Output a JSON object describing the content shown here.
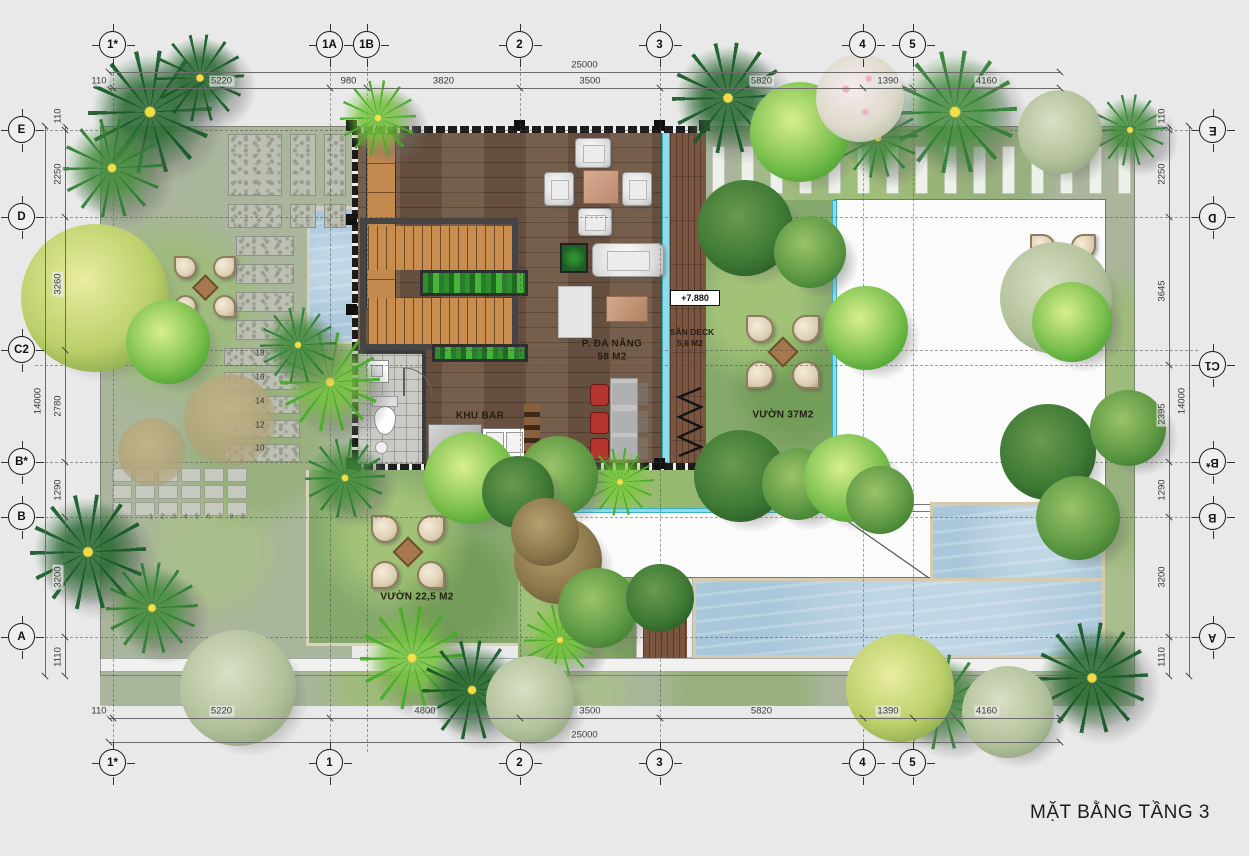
{
  "title": "MẶT BẰNG TẦNG 3",
  "elevation_marker": {
    "text": "+7.880"
  },
  "labels": [
    {
      "text": "P. ĐA NĂNG",
      "x": 612,
      "y": 344,
      "cls": "room"
    },
    {
      "text": "58 M2",
      "x": 612,
      "y": 357,
      "cls": "room"
    },
    {
      "text": "SÂN DECK",
      "x": 692,
      "y": 332,
      "cls": "room-sm"
    },
    {
      "text": "5,6 M2",
      "x": 690,
      "y": 343,
      "cls": "room-sm"
    },
    {
      "text": "VƯỜN 37M2",
      "x": 783,
      "y": 415,
      "cls": "room"
    },
    {
      "text": "KHU BAR",
      "x": 480,
      "y": 416,
      "cls": "room"
    },
    {
      "text": "VƯỜN 22,5 M2",
      "x": 417,
      "y": 597,
      "cls": "room"
    }
  ],
  "grid": {
    "cols": [
      {
        "label": "1*",
        "x": 113
      },
      {
        "label": "1A",
        "x": 330
      },
      {
        "label": "1B",
        "x": 367
      },
      {
        "label": "2",
        "x": 520
      },
      {
        "label": "3",
        "x": 660
      },
      {
        "label": "4",
        "x": 863
      },
      {
        "label": "5",
        "x": 913
      }
    ],
    "rows": [
      {
        "label": "E",
        "y": 130
      },
      {
        "label": "D",
        "y": 217
      },
      {
        "label": "C2",
        "y": 350
      },
      {
        "label": "C1",
        "y": 365
      },
      {
        "label": "B*",
        "y": 462
      },
      {
        "label": "B",
        "y": 517
      },
      {
        "label": "A",
        "y": 637
      }
    ],
    "bubbles": [
      {
        "label": "1*",
        "x": 113,
        "y": 45
      },
      {
        "label": "1A",
        "x": 330,
        "y": 45
      },
      {
        "label": "1B",
        "x": 367,
        "y": 45
      },
      {
        "label": "2",
        "x": 520,
        "y": 45
      },
      {
        "label": "3",
        "x": 660,
        "y": 45
      },
      {
        "label": "4",
        "x": 863,
        "y": 45
      },
      {
        "label": "5",
        "x": 913,
        "y": 45
      },
      {
        "label": "1*",
        "x": 113,
        "y": 763
      },
      {
        "label": "1",
        "x": 330,
        "y": 763
      },
      {
        "label": "2",
        "x": 520,
        "y": 763
      },
      {
        "label": "3",
        "x": 660,
        "y": 763
      },
      {
        "label": "4",
        "x": 863,
        "y": 763
      },
      {
        "label": "5",
        "x": 913,
        "y": 763
      },
      {
        "label": "E",
        "x": 22,
        "y": 130
      },
      {
        "label": "D",
        "x": 22,
        "y": 217
      },
      {
        "label": "C2",
        "x": 22,
        "y": 350
      },
      {
        "label": "B*",
        "x": 22,
        "y": 462
      },
      {
        "label": "B",
        "x": 22,
        "y": 517
      },
      {
        "label": "A",
        "x": 22,
        "y": 637
      },
      {
        "label": "E",
        "x": 1213,
        "y": 130,
        "rot": true
      },
      {
        "label": "D",
        "x": 1213,
        "y": 217,
        "rot": true
      },
      {
        "label": "C1",
        "x": 1213,
        "y": 365,
        "rot": true
      },
      {
        "label": "B*",
        "x": 1213,
        "y": 462,
        "rot": true
      },
      {
        "label": "B",
        "x": 1213,
        "y": 517,
        "rot": true
      },
      {
        "label": "A",
        "x": 1213,
        "y": 637,
        "rot": true
      }
    ]
  },
  "dims": {
    "top": {
      "total": {
        "label": "25000",
        "from": 109,
        "to": 1060,
        "y": 72
      },
      "line_y": 88,
      "segments": [
        {
          "label": "110",
          "from": 109,
          "to": 113
        },
        {
          "label": "5220",
          "from": 113,
          "to": 330
        },
        {
          "label": "980",
          "from": 330,
          "to": 367
        },
        {
          "label": "3820",
          "from": 367,
          "to": 520
        },
        {
          "label": "3500",
          "from": 520,
          "to": 660
        },
        {
          "label": "5820",
          "from": 660,
          "to": 863
        },
        {
          "label": "1390",
          "from": 863,
          "to": 913
        },
        {
          "label": "4160",
          "from": 913,
          "to": 1060
        }
      ]
    },
    "bottom": {
      "total": {
        "label": "25000",
        "from": 109,
        "to": 1060,
        "y": 742
      },
      "line_y": 718,
      "segments": [
        {
          "label": "110",
          "from": 109,
          "to": 113
        },
        {
          "label": "5220",
          "from": 113,
          "to": 330
        },
        {
          "label": "4800",
          "from": 330,
          "to": 520
        },
        {
          "label": "3500",
          "from": 520,
          "to": 660
        },
        {
          "label": "5820",
          "from": 660,
          "to": 863
        },
        {
          "label": "1390",
          "from": 863,
          "to": 913
        },
        {
          "label": "4160",
          "from": 913,
          "to": 1060
        }
      ]
    },
    "left": {
      "total": {
        "label": "14000",
        "from": 126,
        "to": 676,
        "x": 45
      },
      "line_x": 65,
      "segments": [
        {
          "label": "110",
          "from": 126,
          "to": 130
        },
        {
          "label": "2250",
          "from": 130,
          "to": 217
        },
        {
          "label": "3260",
          "from": 217,
          "to": 350
        },
        {
          "label": "2780",
          "from": 350,
          "to": 462
        },
        {
          "label": "1290",
          "from": 462,
          "to": 517
        },
        {
          "label": "3200",
          "from": 517,
          "to": 637
        },
        {
          "label": "1110",
          "from": 637,
          "to": 676
        }
      ]
    },
    "right": {
      "total": {
        "label": "14000",
        "from": 126,
        "to": 676,
        "x": 1189
      },
      "line_x": 1169,
      "segments": [
        {
          "label": "110",
          "from": 126,
          "to": 130
        },
        {
          "label": "2250",
          "from": 130,
          "to": 217
        },
        {
          "label": "3645",
          "from": 217,
          "to": 365
        },
        {
          "label": "2395",
          "from": 365,
          "to": 462
        },
        {
          "label": "1290",
          "from": 462,
          "to": 517
        },
        {
          "label": "3200",
          "from": 517,
          "to": 637
        },
        {
          "label": "1110",
          "from": 637,
          "to": 676
        }
      ]
    }
  },
  "steps": {
    "x": 260,
    "numbers": [
      {
        "t": "18",
        "y": 353
      },
      {
        "t": "16",
        "y": 377
      },
      {
        "t": "14",
        "y": 401
      },
      {
        "t": "12",
        "y": 425
      },
      {
        "t": "10",
        "y": 448
      }
    ],
    "path_numbers": [
      "1",
      "2",
      "3",
      "4",
      "5",
      "6",
      "7",
      "8",
      "9"
    ],
    "path_x0": 151,
    "path_dx": 11.5,
    "path_y": 517
  },
  "hardscape": {
    "tiles": [
      [
        228,
        134,
        54,
        62
      ],
      [
        290,
        134,
        26,
        62
      ],
      [
        324,
        134,
        22,
        62
      ],
      [
        228,
        204,
        54,
        24
      ],
      [
        290,
        204,
        26,
        24
      ],
      [
        324,
        204,
        22,
        24
      ]
    ],
    "slabs": [
      [
        236,
        236,
        58,
        20
      ],
      [
        236,
        264,
        58,
        20
      ],
      [
        236,
        292,
        58,
        20
      ],
      [
        236,
        320,
        58,
        20
      ]
    ],
    "step_slabs": [
      [
        224,
        348,
        76,
        18
      ],
      [
        224,
        372,
        76,
        18
      ],
      [
        224,
        396,
        76,
        18
      ],
      [
        224,
        420,
        76,
        18
      ],
      [
        224,
        444,
        76,
        18
      ]
    ],
    "small_tiles": {
      "x": 112,
      "y": 468,
      "cols": 6,
      "rows": 3,
      "w": 20,
      "h": 14,
      "gap": 3
    },
    "slat_strip": {
      "x": 712,
      "y": 146,
      "count": 15,
      "step": 29,
      "w": 13,
      "h": 48
    }
  },
  "seatings": [
    {
      "x": 205,
      "y": 287,
      "s": 0.85
    },
    {
      "x": 783,
      "y": 352,
      "s": 1
    },
    {
      "x": 408,
      "y": 552,
      "s": 1
    },
    {
      "x": 1063,
      "y": 267,
      "s": 0.9
    }
  ],
  "trees": [
    [
      "palm",
      "dark",
      150,
      112,
      62
    ],
    [
      "palm",
      "mid",
      112,
      168,
      50
    ],
    [
      "palm",
      "dark",
      200,
      78,
      44
    ],
    [
      "palm",
      "bright",
      378,
      118,
      38
    ],
    [
      "palm",
      "bright",
      330,
      382,
      50
    ],
    [
      "palm",
      "mid",
      298,
      345,
      38
    ],
    [
      "palm",
      "dark",
      88,
      552,
      58
    ],
    [
      "palm",
      "mid",
      152,
      608,
      46
    ],
    [
      "palm",
      "bright",
      412,
      658,
      52
    ],
    [
      "palm",
      "mid",
      345,
      478,
      40
    ],
    [
      "palm",
      "dark",
      472,
      690,
      50
    ],
    [
      "palm",
      "dark",
      728,
      98,
      56
    ],
    [
      "palm",
      "mid",
      955,
      112,
      62
    ],
    [
      "palm",
      "mid",
      878,
      138,
      40
    ],
    [
      "palm",
      "dark",
      1092,
      678,
      56
    ],
    [
      "palm",
      "mid",
      942,
      702,
      48
    ],
    [
      "palm",
      "bright",
      620,
      482,
      34
    ],
    [
      "palm",
      "bright",
      560,
      640,
      36
    ],
    [
      "palm",
      "mid",
      1130,
      130,
      36
    ],
    [
      "canopy",
      "yellow",
      95,
      298,
      74
    ],
    [
      "canopy",
      "bright",
      168,
      342,
      42
    ],
    [
      "canopy",
      "bright",
      800,
      132,
      50
    ],
    [
      "canopy",
      "pink",
      860,
      98,
      44
    ],
    [
      "canopy",
      "pale",
      1060,
      132,
      42
    ],
    [
      "canopy",
      "dark",
      745,
      228,
      48
    ],
    [
      "canopy",
      "mid",
      810,
      252,
      36
    ],
    [
      "canopy",
      "bright",
      866,
      328,
      42
    ],
    [
      "canopy",
      "dark",
      740,
      476,
      46
    ],
    [
      "canopy",
      "mid",
      798,
      484,
      36
    ],
    [
      "canopy",
      "pale",
      1056,
      298,
      56
    ],
    [
      "canopy",
      "bright",
      1072,
      322,
      40
    ],
    [
      "canopy",
      "dark",
      1048,
      452,
      48
    ],
    [
      "canopy",
      "mid",
      1078,
      518,
      42
    ],
    [
      "canopy",
      "bright",
      470,
      478,
      46
    ],
    [
      "canopy",
      "mid",
      558,
      476,
      40
    ],
    [
      "canopy",
      "dark",
      518,
      492,
      36
    ],
    [
      "canopy",
      "brown",
      558,
      560,
      44
    ],
    [
      "canopy",
      "mid",
      598,
      608,
      40
    ],
    [
      "canopy",
      "dark",
      660,
      598,
      34
    ],
    [
      "canopy",
      "yellow",
      900,
      688,
      54
    ],
    [
      "canopy",
      "pale",
      1008,
      712,
      46
    ],
    [
      "canopy",
      "pale",
      238,
      688,
      58
    ],
    [
      "canopy",
      "pale",
      530,
      700,
      44
    ],
    [
      "canopy",
      "bright",
      848,
      478,
      44
    ],
    [
      "canopy",
      "mid",
      880,
      500,
      34
    ],
    [
      "canopy",
      "sand",
      230,
      420,
      46
    ],
    [
      "canopy",
      "sand",
      152,
      452,
      34
    ],
    [
      "canopy",
      "brown",
      545,
      532,
      34
    ],
    [
      "canopy",
      "mid",
      1128,
      428,
      38
    ]
  ],
  "columns": [
    [
      346,
      120
    ],
    [
      514,
      120
    ],
    [
      654,
      120
    ],
    [
      699,
      120
    ],
    [
      346,
      214
    ],
    [
      346,
      304
    ],
    [
      346,
      458
    ],
    [
      514,
      458
    ],
    [
      654,
      458
    ],
    [
      699,
      458
    ]
  ],
  "bar": {
    "stool_ys": [
      384,
      412,
      438
    ]
  },
  "colors": {
    "background": "#e9e9e9",
    "grass": "#a9b69b",
    "grass_bright": "#85a86d",
    "water": "#a9c7da",
    "wood_floor": "#6f5643",
    "wood_stair": "#c98d4f",
    "deck": "#7c5540",
    "glass": "#8fdbe8",
    "wall": "#2b2b2b",
    "roof_white": "#fbfbfb",
    "pool_border": "#d6cbae",
    "stool_red": "#b5342e"
  }
}
